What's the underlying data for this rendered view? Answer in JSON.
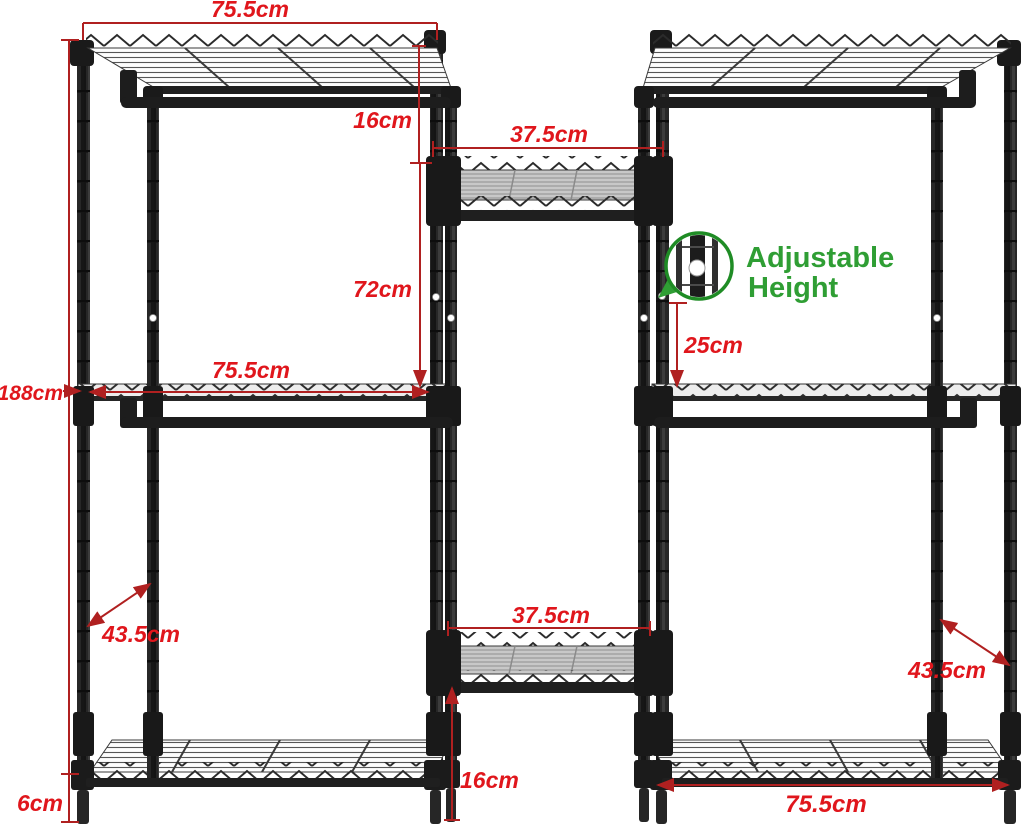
{
  "diagram": {
    "type": "garment-rack-dimension-diagram",
    "labels": {
      "top_shelf_width": "75.5cm",
      "top_rod_drop": "16cm",
      "center_upper_shelf_width": "37.5cm",
      "upper_gap_height": "72cm",
      "adjustable_spacing": "25cm",
      "total_height": "188cm",
      "middle_shelf_width": "75.5cm",
      "left_depth": "43.5cm",
      "center_lower_shelf_width": "37.5cm",
      "lower_gap_height": "16cm",
      "foot_height": "6cm",
      "bottom_shelf_width": "75.5cm",
      "right_depth": "43.5cm"
    },
    "callout": {
      "line1": "Adjustable",
      "line2": "Height"
    },
    "colors": {
      "label_red": "#e0161c",
      "dimension_line_red": "#b02020",
      "callout_green": "#2f9e34",
      "magnifier_ring_green": "#1f8c25",
      "frame_black": "#242424"
    }
  }
}
